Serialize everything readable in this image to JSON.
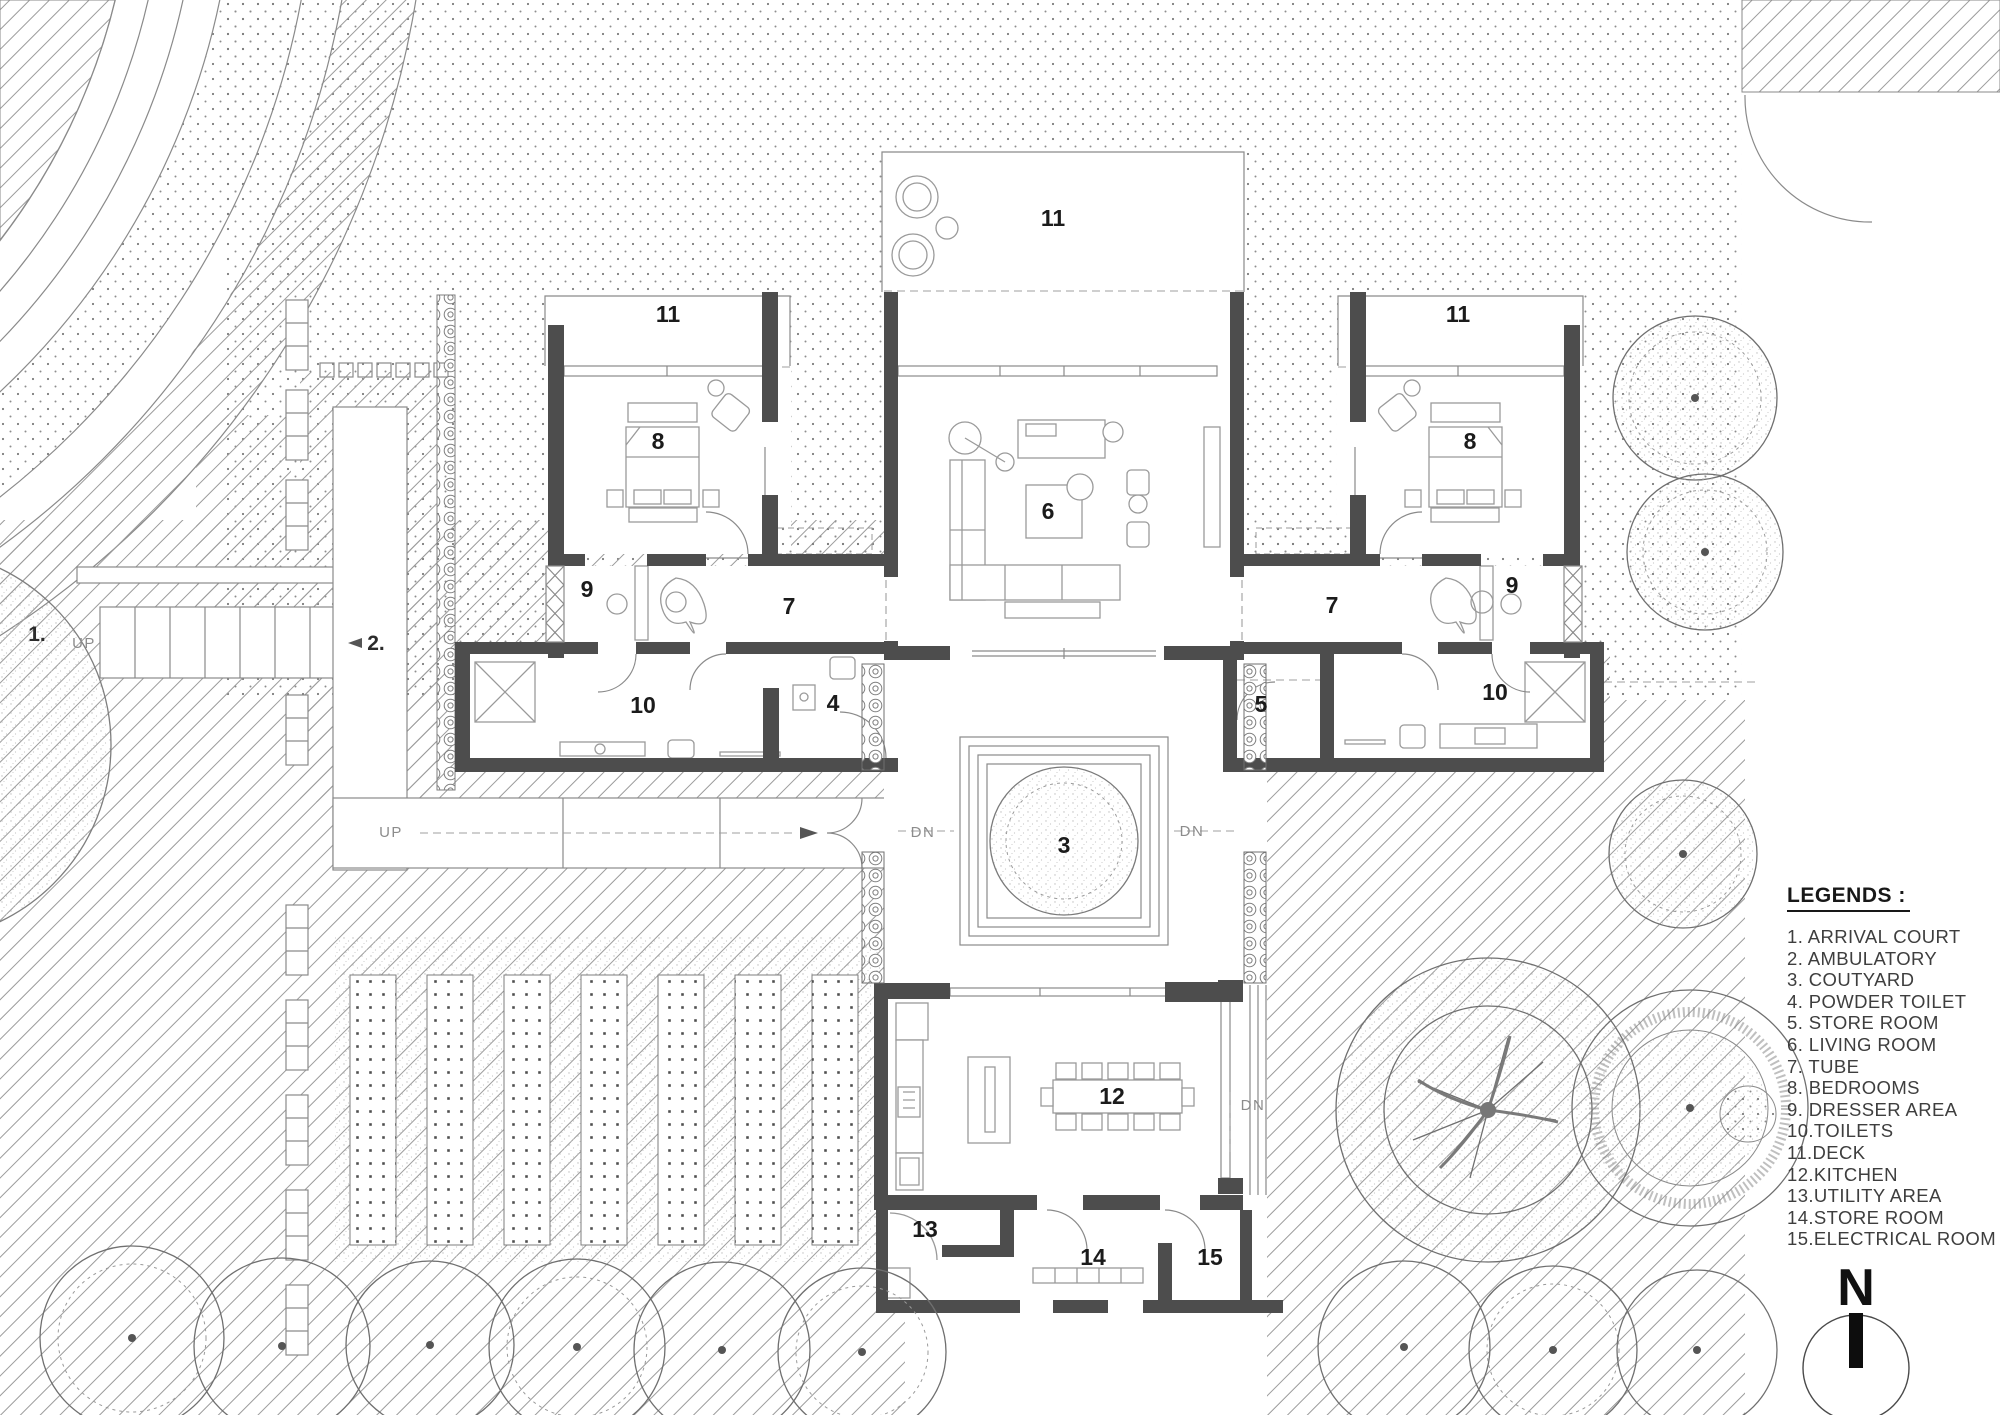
{
  "legend": {
    "heading": "LEGENDS :",
    "items": [
      "1. ARRIVAL COURT",
      "2. AMBULATORY",
      "3. COUTYARD",
      "4. POWDER TOILET",
      "5. STORE ROOM",
      "6. LIVING ROOM",
      "7. TUBE",
      "8. BEDROOMS",
      "9. DRESSER AREA",
      "10.TOILETS",
      "11.DECK",
      "12.KITCHEN",
      "13.UTILITY AREA",
      "14.STORE ROOM",
      "15.ELECTRICAL ROOM"
    ]
  },
  "compass": {
    "north_label": "N"
  },
  "plan": {
    "room_labels": [
      {
        "text": "11"
      },
      {
        "text": "11"
      },
      {
        "text": "11"
      },
      {
        "text": "8"
      },
      {
        "text": "8"
      },
      {
        "text": "6"
      },
      {
        "text": "9"
      },
      {
        "text": "9"
      },
      {
        "text": "7"
      },
      {
        "text": "7"
      },
      {
        "text": "10"
      },
      {
        "text": "4"
      },
      {
        "text": "5"
      },
      {
        "text": "10"
      },
      {
        "text": "3"
      },
      {
        "text": "12"
      },
      {
        "text": "13"
      },
      {
        "text": "14"
      },
      {
        "text": "15"
      }
    ],
    "area_labels": [
      {
        "text": "1."
      },
      {
        "text": "2."
      }
    ],
    "direction_labels": [
      {
        "text": "UP"
      },
      {
        "text": "UP"
      },
      {
        "text": "DN"
      },
      {
        "text": "DN"
      },
      {
        "text": "DN"
      }
    ]
  },
  "colors": {
    "wall": "#4d4d4d",
    "thin_line": "#8a8a8a",
    "paper": "#ffffff",
    "hatch": "#9b9b9b",
    "stipple": "#7d7d7d",
    "label": "#1b1b1b"
  }
}
